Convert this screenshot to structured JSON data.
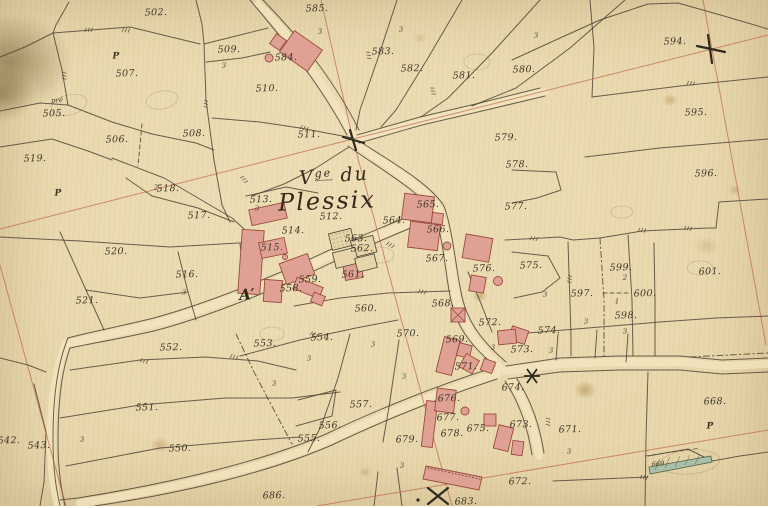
{
  "map": {
    "title": {
      "line1_v": "V",
      "line1_sup": "ge",
      "line1_rest": " du",
      "line2": "Plessix"
    },
    "colors": {
      "paper": "#e8d6aa",
      "ink": "#4a4132",
      "red": "#b4543c",
      "building_fill": "#e0a195",
      "building_stroke": "#9c4a3c",
      "green": "#a9bfa7"
    },
    "icons": [
      "survey-cross-icon",
      "survey-star-icon",
      "washhouse-strip-icon"
    ],
    "labels": [
      {
        "t": "502.",
        "x": 156,
        "y": 13
      },
      {
        "t": "507.",
        "x": 127,
        "y": 74
      },
      {
        "t": "505.",
        "x": 54,
        "y": 114
      },
      {
        "t": "506.",
        "x": 117,
        "y": 140
      },
      {
        "t": "508.",
        "x": 194,
        "y": 134
      },
      {
        "t": "509.",
        "x": 229,
        "y": 50
      },
      {
        "t": "510.",
        "x": 267,
        "y": 89
      },
      {
        "t": "511.",
        "x": 309,
        "y": 135
      },
      {
        "t": "519.",
        "x": 35,
        "y": 159
      },
      {
        "t": "518.",
        "x": 168,
        "y": 189
      },
      {
        "t": "517.",
        "x": 199,
        "y": 216
      },
      {
        "t": "520.",
        "x": 116,
        "y": 252
      },
      {
        "t": "516.",
        "x": 187,
        "y": 275
      },
      {
        "t": "521.",
        "x": 87,
        "y": 301
      },
      {
        "t": "585.",
        "x": 317,
        "y": 9
      },
      {
        "t": "583.",
        "x": 383,
        "y": 52
      },
      {
        "t": "582.",
        "x": 412,
        "y": 69
      },
      {
        "t": "581.",
        "x": 464,
        "y": 76
      },
      {
        "t": "580.",
        "x": 524,
        "y": 70
      },
      {
        "t": "584.",
        "x": 286,
        "y": 58
      },
      {
        "t": "594.",
        "x": 675,
        "y": 42
      },
      {
        "t": "595.",
        "x": 696,
        "y": 113
      },
      {
        "t": "596.",
        "x": 706,
        "y": 174
      },
      {
        "t": "579.",
        "x": 506,
        "y": 138
      },
      {
        "t": "578.",
        "x": 517,
        "y": 165
      },
      {
        "t": "577.",
        "x": 516,
        "y": 207
      },
      {
        "t": "512.",
        "x": 331,
        "y": 217
      },
      {
        "t": "513.",
        "x": 261,
        "y": 200
      },
      {
        "t": "514.",
        "x": 293,
        "y": 231
      },
      {
        "t": "515.",
        "x": 272,
        "y": 248
      },
      {
        "t": "563.",
        "x": 356,
        "y": 239
      },
      {
        "t": "562.",
        "x": 362,
        "y": 249
      },
      {
        "t": "561.",
        "x": 353,
        "y": 275
      },
      {
        "t": "564.",
        "x": 394,
        "y": 221
      },
      {
        "t": "559.",
        "x": 310,
        "y": 280
      },
      {
        "t": "558.",
        "x": 291,
        "y": 289
      },
      {
        "t": "560.",
        "x": 366,
        "y": 309
      },
      {
        "t": "565.",
        "x": 428,
        "y": 205
      },
      {
        "t": "566.",
        "x": 438,
        "y": 230
      },
      {
        "t": "567.",
        "x": 437,
        "y": 259
      },
      {
        "t": "576.",
        "x": 484,
        "y": 269
      },
      {
        "t": "575.",
        "x": 531,
        "y": 266
      },
      {
        "t": "568.",
        "x": 443,
        "y": 304
      },
      {
        "t": "570.",
        "x": 408,
        "y": 334
      },
      {
        "t": "569.",
        "x": 457,
        "y": 340
      },
      {
        "t": "571.",
        "x": 466,
        "y": 367
      },
      {
        "t": "572.",
        "x": 490,
        "y": 323
      },
      {
        "t": "573.",
        "x": 522,
        "y": 350
      },
      {
        "t": "574.",
        "x": 549,
        "y": 331
      },
      {
        "t": "597.",
        "x": 582,
        "y": 294
      },
      {
        "t": "599.",
        "x": 621,
        "y": 268
      },
      {
        "t": "600.",
        "x": 645,
        "y": 294
      },
      {
        "t": "598.",
        "x": 626,
        "y": 316
      },
      {
        "t": "601.",
        "x": 710,
        "y": 272
      },
      {
        "t": "552.",
        "x": 171,
        "y": 348
      },
      {
        "t": "553.",
        "x": 265,
        "y": 344
      },
      {
        "t": "554.",
        "x": 322,
        "y": 338
      },
      {
        "t": "557.",
        "x": 361,
        "y": 405
      },
      {
        "t": "556.",
        "x": 330,
        "y": 426
      },
      {
        "t": "555.",
        "x": 309,
        "y": 439
      },
      {
        "t": "551.",
        "x": 147,
        "y": 408
      },
      {
        "t": "550.",
        "x": 180,
        "y": 449
      },
      {
        "t": "542.",
        "x": 9,
        "y": 441
      },
      {
        "t": "543.",
        "x": 39,
        "y": 446
      },
      {
        "t": "686.",
        "x": 274,
        "y": 496
      },
      {
        "t": "683.",
        "x": 466,
        "y": 502
      },
      {
        "t": "679.",
        "x": 407,
        "y": 440
      },
      {
        "t": "676.",
        "x": 449,
        "y": 399
      },
      {
        "t": "677.",
        "x": 448,
        "y": 418
      },
      {
        "t": "678.",
        "x": 452,
        "y": 434
      },
      {
        "t": "675.",
        "x": 478,
        "y": 429
      },
      {
        "t": "674.",
        "x": 513,
        "y": 388
      },
      {
        "t": "673.",
        "x": 521,
        "y": 425
      },
      {
        "t": "671.",
        "x": 570,
        "y": 430
      },
      {
        "t": "672.",
        "x": 520,
        "y": 482
      },
      {
        "t": "668.",
        "x": 715,
        "y": 402
      },
      {
        "t": "669",
        "x": 658,
        "y": 464,
        "k": "small"
      },
      {
        "t": "P",
        "x": 116,
        "y": 57,
        "k": "letter"
      },
      {
        "t": "P",
        "x": 58,
        "y": 194,
        "k": "letter"
      },
      {
        "t": "P",
        "x": 710,
        "y": 427,
        "k": "letter"
      },
      {
        "t": "pré",
        "x": 57,
        "y": 101,
        "k": "mark"
      },
      {
        "t": "A′",
        "x": 247,
        "y": 295,
        "k": "bigletter"
      },
      {
        "t": "2",
        "x": 156,
        "y": 188,
        "k": "mark"
      },
      {
        "t": "2",
        "x": 625,
        "y": 278,
        "k": "mark"
      },
      {
        "t": "1",
        "x": 617,
        "y": 302,
        "k": "mark"
      },
      {
        "t": "3",
        "x": 224,
        "y": 66,
        "k": "mark"
      },
      {
        "t": "3",
        "x": 320,
        "y": 32,
        "k": "mark"
      },
      {
        "t": "3",
        "x": 401,
        "y": 30,
        "k": "mark"
      },
      {
        "t": "3",
        "x": 536,
        "y": 36,
        "k": "mark"
      },
      {
        "t": "3",
        "x": 184,
        "y": 293,
        "k": "mark"
      },
      {
        "t": "3",
        "x": 545,
        "y": 295,
        "k": "mark"
      },
      {
        "t": "3",
        "x": 586,
        "y": 322,
        "k": "mark"
      },
      {
        "t": "3",
        "x": 625,
        "y": 332,
        "k": "mark"
      },
      {
        "t": "3",
        "x": 493,
        "y": 348,
        "k": "mark"
      },
      {
        "t": "3",
        "x": 551,
        "y": 351,
        "k": "mark"
      },
      {
        "t": "3",
        "x": 309,
        "y": 359,
        "k": "mark"
      },
      {
        "t": "3",
        "x": 274,
        "y": 384,
        "k": "mark"
      },
      {
        "t": "3",
        "x": 373,
        "y": 345,
        "k": "mark"
      },
      {
        "t": "3",
        "x": 82,
        "y": 440,
        "k": "mark"
      },
      {
        "t": "3",
        "x": 402,
        "y": 466,
        "k": "mark"
      },
      {
        "t": "3",
        "x": 404,
        "y": 377,
        "k": "mark"
      },
      {
        "t": "3",
        "x": 569,
        "y": 452,
        "k": "mark"
      },
      {
        "t": "3",
        "x": 257,
        "y": 209,
        "k": "mark"
      }
    ]
  }
}
